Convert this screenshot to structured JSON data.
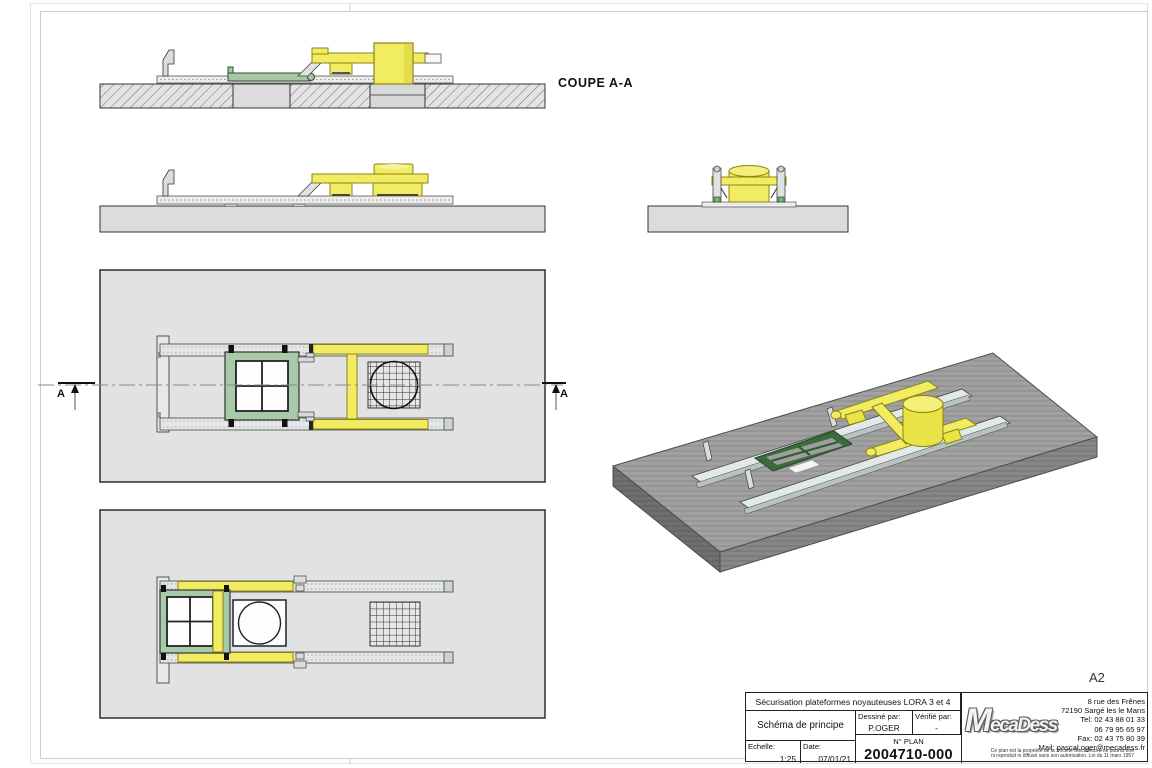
{
  "sheet": {
    "format": "A2",
    "section_label": "COUPE A-A",
    "section_marker": "A"
  },
  "title_block": {
    "project_title": "Sécurisation plateformes noyauteuses LORA 3 et 4",
    "drawing_title": "Schéma de principe",
    "drawn_by_label": "Dessiné par:",
    "drawn_by": "P.OGER",
    "checked_by_label": "Vérifié par:",
    "checked_by": "-",
    "scale_label": "Echelle:",
    "scale": "1:25",
    "date_label": "Date:",
    "date": "07/01/21",
    "plan_no_label": "N° PLAN",
    "plan_no": "2004710-000"
  },
  "company": {
    "logo_text": "MecaDess",
    "address_line1": "8 rue des Frênes",
    "address_line2": "72190 Sargé les le Mans",
    "tel1": "Tel: 02 43 88 01 33",
    "tel2": "06 79 95 65 97",
    "fax": "Fax: 02 43 75 80 39",
    "mail": "Mail: pascal.oger@mecadess.fr",
    "legal_line1": "Ce plan est la propriété de la Société MecaDess il ne pourra être",
    "legal_line2": "ni reproduit ni diffusé sans son autorisation. Loi du 11 mars 1957"
  }
}
